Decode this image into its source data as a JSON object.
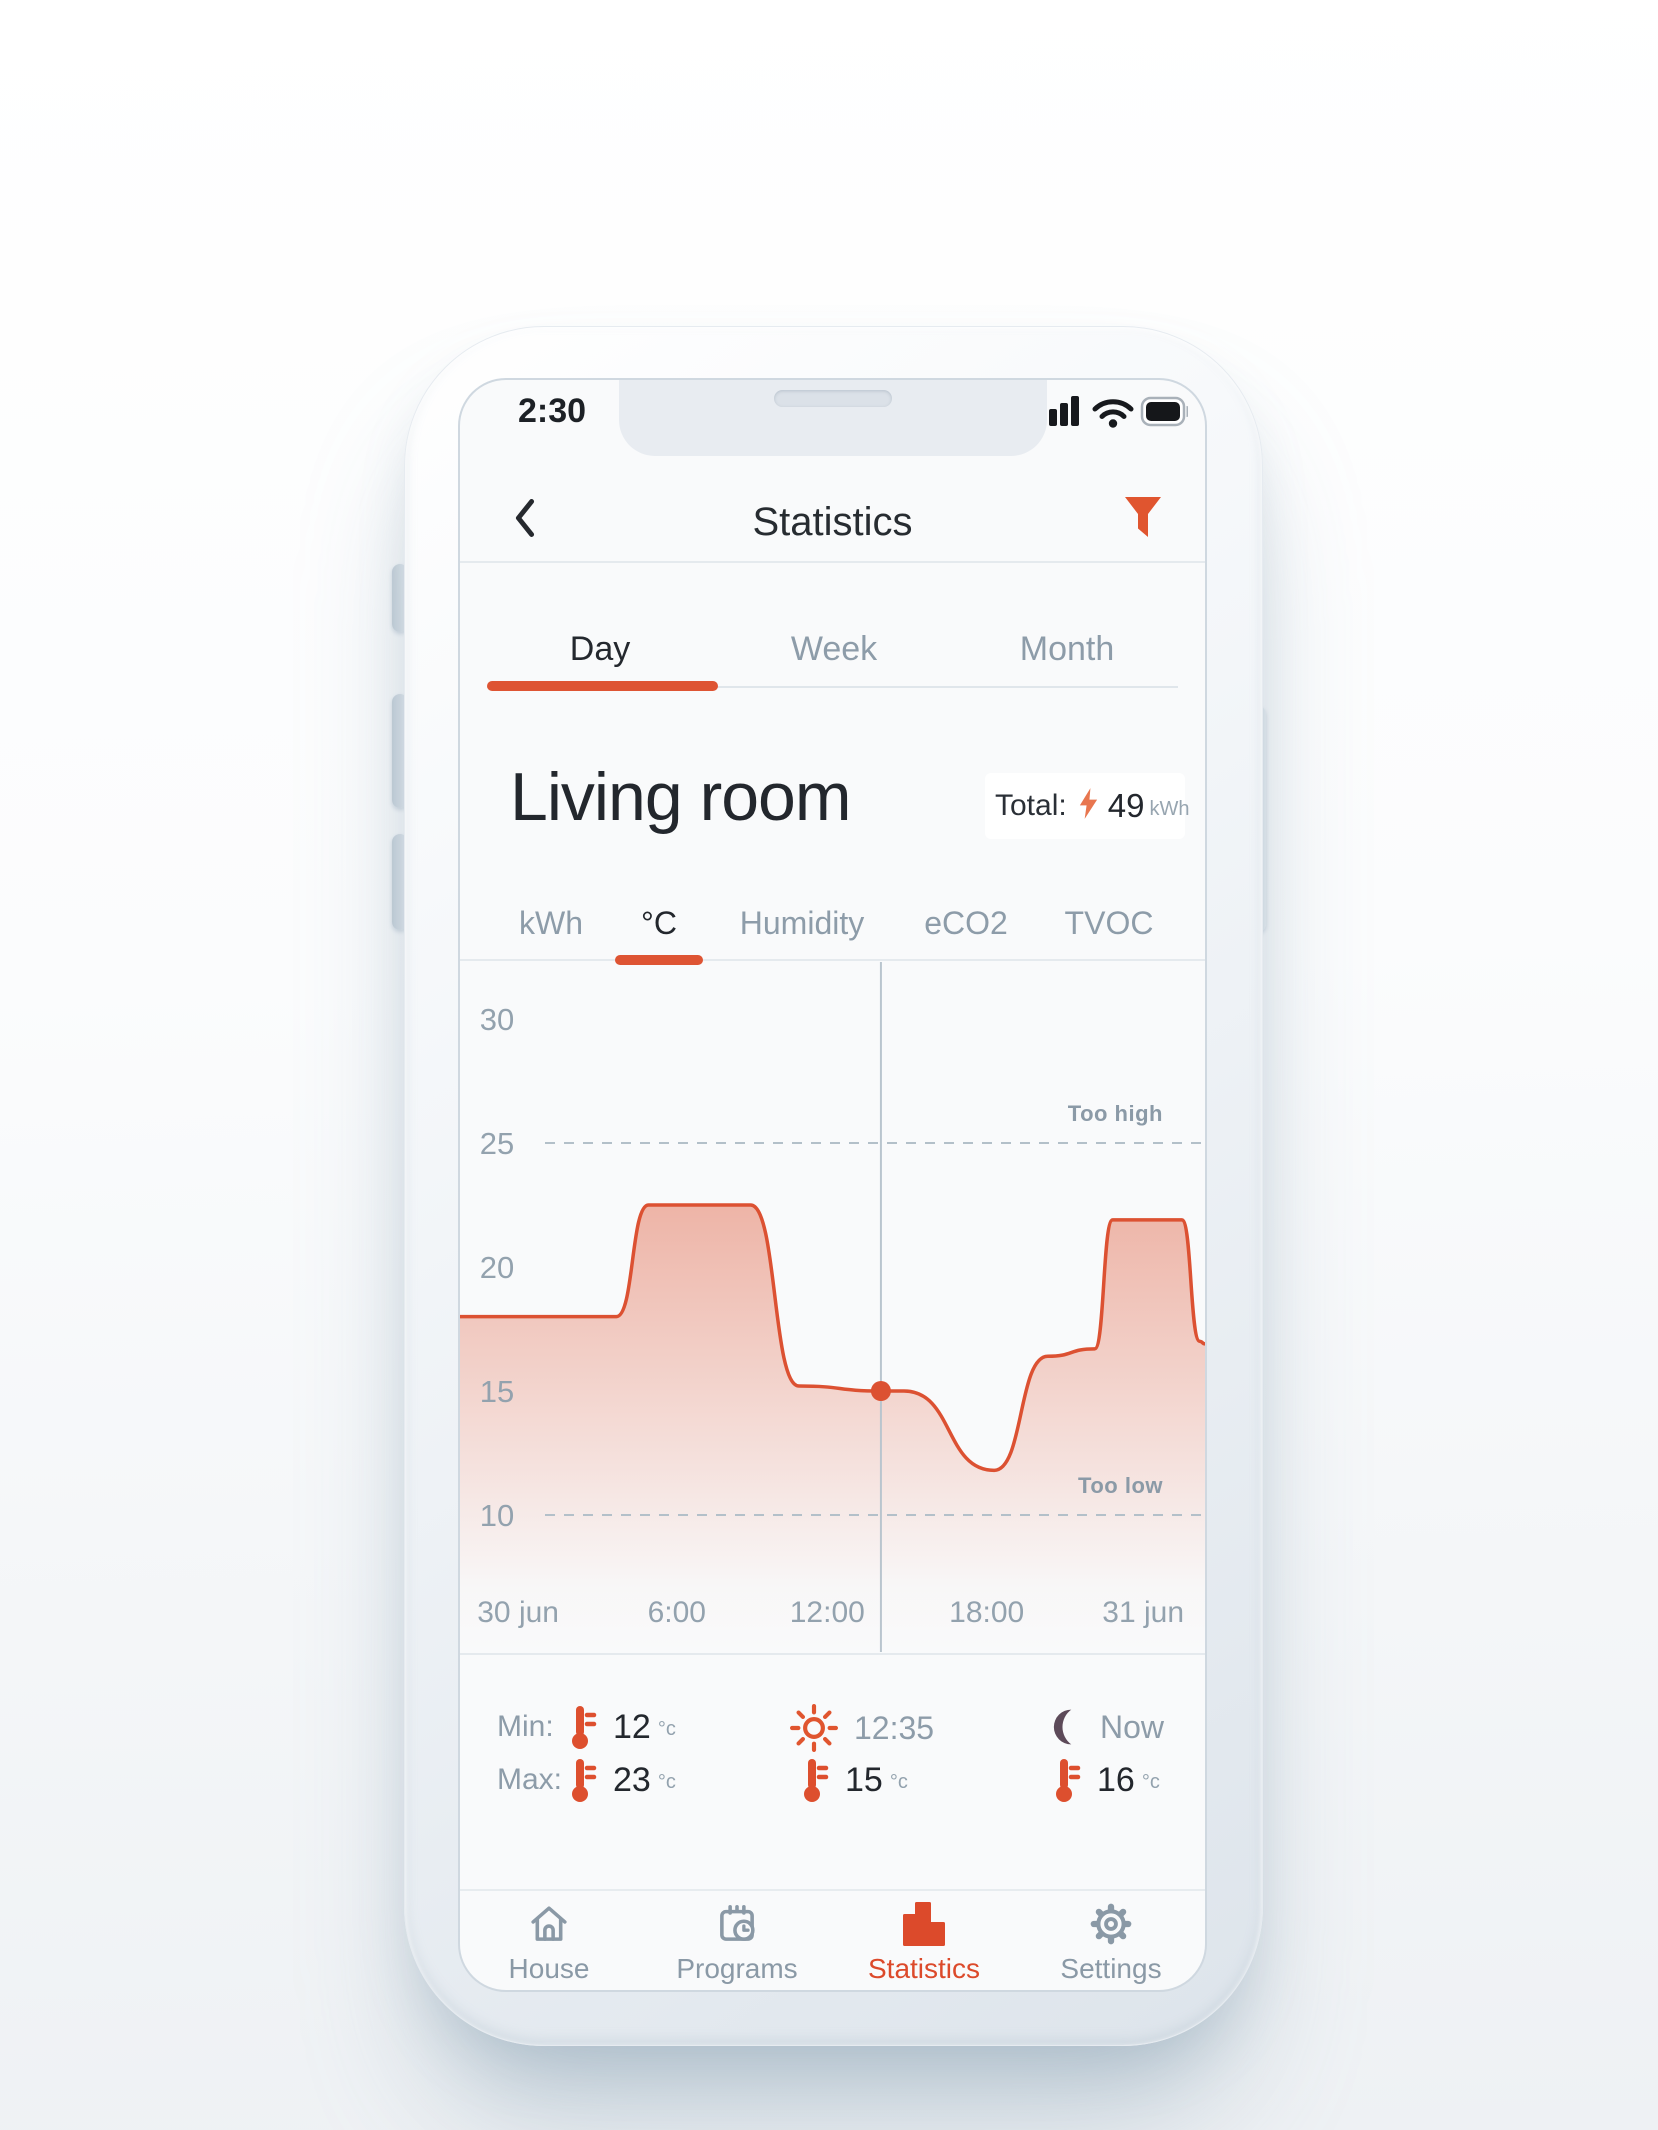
{
  "status_bar": {
    "time": "2:30"
  },
  "header": {
    "title": "Statistics"
  },
  "period_tabs": {
    "items": [
      {
        "label": "Day",
        "active": true
      },
      {
        "label": "Week",
        "active": false
      },
      {
        "label": "Month",
        "active": false
      }
    ]
  },
  "room": {
    "name": "Living room",
    "total_label": "Total:",
    "total_value": "49",
    "total_unit": "kWh"
  },
  "metric_tabs": {
    "items": [
      {
        "label": "kWh",
        "active": false
      },
      {
        "label": "°C",
        "active": true
      },
      {
        "label": "Humidity",
        "active": false
      },
      {
        "label": "eCO2",
        "active": false
      },
      {
        "label": "TVOC",
        "active": false
      }
    ]
  },
  "chart_data": {
    "type": "area",
    "title": "Living room temperature (Day)",
    "ylabel": "°C",
    "ylim": [
      4.5,
      32.5
    ],
    "y_ticks": [
      30,
      25,
      20,
      15,
      10
    ],
    "x_ticks": [
      {
        "label": "30 jun",
        "pct": 7.8
      },
      {
        "label": "6:00",
        "pct": 29.1
      },
      {
        "label": "12:00",
        "pct": 49.3
      },
      {
        "label": "18:00",
        "pct": 70.7
      },
      {
        "label": "31 jun",
        "pct": 91.7
      }
    ],
    "thresholds": {
      "high": {
        "value": 25,
        "label": "Too high"
      },
      "low": {
        "value": 10,
        "label": "Too low"
      }
    },
    "now_marker": {
      "pct": 56.5,
      "temp": 15
    },
    "grid": "dashed thresholds only",
    "legend": "none",
    "series": [
      {
        "name": "Temperature",
        "points": [
          {
            "pct": 0,
            "temp": 18
          },
          {
            "pct": 21,
            "temp": 18
          },
          {
            "pct": 25.3,
            "temp": 22.5
          },
          {
            "pct": 39,
            "temp": 22.5
          },
          {
            "pct": 45.5,
            "temp": 15.2
          },
          {
            "pct": 56.5,
            "temp": 15
          },
          {
            "pct": 59.6,
            "temp": 15
          },
          {
            "pct": 71.7,
            "temp": 11.8
          },
          {
            "pct": 78.9,
            "temp": 16.4
          },
          {
            "pct": 85.2,
            "temp": 16.7
          },
          {
            "pct": 87.6,
            "temp": 21.9
          },
          {
            "pct": 96.9,
            "temp": 21.9
          },
          {
            "pct": 99.3,
            "temp": 17
          },
          {
            "pct": 100,
            "temp": 16.9
          }
        ]
      }
    ]
  },
  "stats": {
    "rows": [
      {
        "label": "Min:",
        "value": "12",
        "unit": "°c"
      },
      {
        "label": "Max:",
        "value": "23",
        "unit": "°c"
      }
    ],
    "midday": {
      "time": "12:35",
      "temp": "15",
      "unit": "°c"
    },
    "now": {
      "label": "Now",
      "temp": "16",
      "unit": "°c"
    }
  },
  "nav": {
    "items": [
      {
        "label": "House",
        "active": false
      },
      {
        "label": "Programs",
        "active": false
      },
      {
        "label": "Statistics",
        "active": true
      },
      {
        "label": "Settings",
        "active": false
      }
    ]
  },
  "colors": {
    "accent": "#DE5433",
    "curve": "#DC5132",
    "fill_top": "rgba(223,84,51,0.42)",
    "moon": "#5D4A59",
    "text_dark": "#23272D",
    "text_gray": "#8D9CA9",
    "tick_gray": "#93A2AE",
    "divider": "#E5EAEE"
  }
}
